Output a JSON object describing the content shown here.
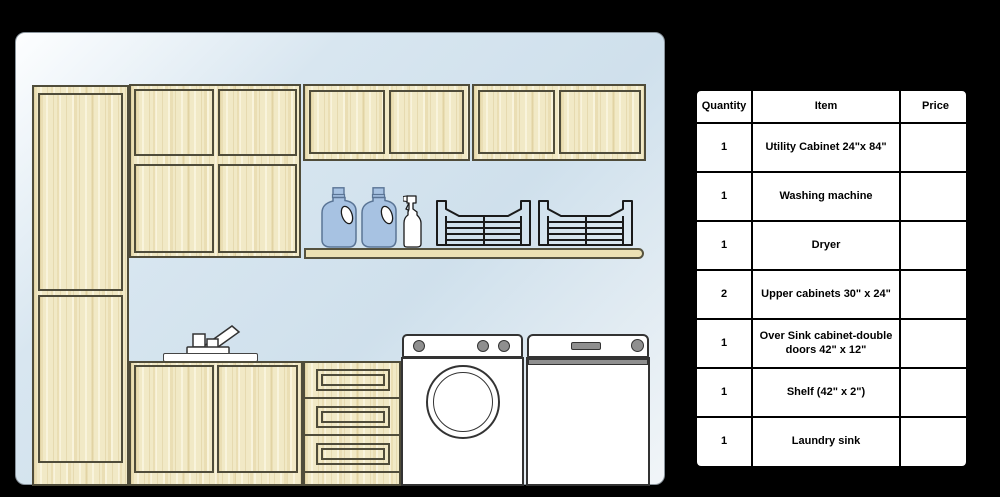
{
  "colors": {
    "page_bg": "#000000",
    "canvas_grad_1": "#fdfeff",
    "canvas_grad_2": "#d8e6f0",
    "canvas_grad_3": "#cfe0ec",
    "canvas_grad_4": "#f1f5f8",
    "wood": "#f1e9c6",
    "wood_outline": "#4f4c3a",
    "shelf_wood": "#ece1b4",
    "jug_blue": "#a7c2e2",
    "jug_outline": "#5a7495",
    "appliance_white": "#ffffff",
    "appliance_outline": "#333333",
    "metal_gray": "#8f8f8f",
    "table_border": "#000000",
    "table_bg": "#ffffff",
    "table_text": "#000000"
  },
  "scene_objects": [
    "utility-cabinet",
    "upper-cabinet-grid",
    "over-sink-cabinet",
    "upper-cabinet-right",
    "wall-shelf",
    "detergent-jug-1",
    "detergent-jug-2",
    "spray-bottle",
    "laundry-basket-1",
    "laundry-basket-2",
    "sink-base-cabinet",
    "laundry-sink-faucet",
    "drawer-cabinet",
    "washing-machine",
    "dryer"
  ],
  "parts_table": {
    "headers": [
      "Quantity",
      "Item",
      "Price"
    ],
    "rows": [
      {
        "quantity": "1",
        "item": "Utility Cabinet 24\"x 84\"",
        "price": ""
      },
      {
        "quantity": "1",
        "item": "Washing machine",
        "price": ""
      },
      {
        "quantity": "1",
        "item": "Dryer",
        "price": ""
      },
      {
        "quantity": "2",
        "item": "Upper cabinets 30\" x 24\"",
        "price": ""
      },
      {
        "quantity": "1",
        "item": "Over Sink cabinet-double doors 42\" x 12\"",
        "price": ""
      },
      {
        "quantity": "1",
        "item": "Shelf (42\" x 2\")",
        "price": ""
      },
      {
        "quantity": "1",
        "item": "Laundry sink",
        "price": ""
      }
    ]
  }
}
